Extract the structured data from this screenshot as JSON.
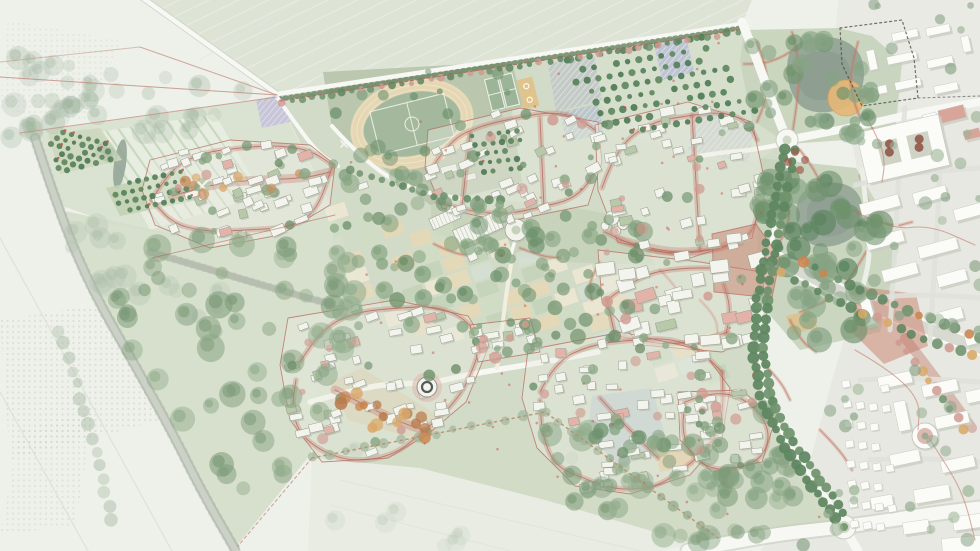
{
  "map": {
    "kind": "urban-masterplan-site-plan",
    "style": "watercolor aerial masterplan, no text labels visible in image",
    "palette": {
      "bg": "#eef0ea",
      "fieldSage": "#dde4d6",
      "fieldWest": "#dae2d2",
      "fieldBottom": "#e9ece3",
      "siteGreen": "#cfd9c3",
      "parkGreen": "#c8d4bd",
      "sportsGreen": "#b8c5ad",
      "stripeBase": "#e7ede0",
      "townGround": "#e7e8e1",
      "suburbGround": "#e9eae4",
      "roadWhite": "#f7f8f3",
      "roadCasing": "#c8cdc1",
      "roadGray": "#d8d9d1",
      "avenueInner": "#eef0ea",
      "streetRed": "#bf7062",
      "streetRedLine": "#b4685c",
      "plazaRed": "#c97f6e",
      "redPath": "#c4796a",
      "redDot": "#c4584a",
      "bldgFill": "#f3f4ed",
      "bldgStroke": "#989e90",
      "bldgShadow": "#b7beaf",
      "pinkRoof": "#e3b3a9",
      "greenRoof": "#b7c9a8",
      "townFill": "#fbfbf8",
      "townShadow": "#c9cdc2",
      "trackTan": "#e6d7b4",
      "pitchGreen": "#a3b89c",
      "courtGreen": "#9cb598",
      "courtTan": "#e0c48e",
      "courtLine": "#eef2e8",
      "orchardTree": "#55815a",
      "parkTree": "#6f926d",
      "parkTreeDark": "#5d8560",
      "softTree": "#8aa585",
      "faintTree": "#a9bca7",
      "pinkTree": "#cf9b91",
      "autumn1": "#d9a869",
      "autumn2": "#c9854f",
      "darkRedTree": "#8e4f41",
      "pond": "#93a496",
      "pondDark": "#87988c",
      "waterBlue": "#a7bdbd",
      "bluePark": "#9db4cb",
      "orangePlaza": "#e6b877",
      "lavender": "#c6c2d8",
      "solarBlue": "#bcc2d2",
      "solarGray": "#c2c9c6",
      "boundaryRed": "#b4675a",
      "fieldLineRed": "#c08b7c",
      "boundaryDot": "#4a4f49",
      "dottedPath": "#b98f6f",
      "hedgeGreen": "#5c7a55",
      "wallGray": "#c3c9bc"
    },
    "features": [
      "farm-fields",
      "field-boundary-lines",
      "tree-lined-avenue",
      "striped-crop-parcel",
      "west-orchards",
      "cigar-pond",
      "north-hedge-boundary",
      "country-road",
      "sports-park",
      "athletics-track",
      "football-pitch",
      "tennis-courts",
      "basketball-court",
      "orchard-grid",
      "solar-panel-fields",
      "lavender-plot",
      "pond-park",
      "park-pond",
      "orange-circle-plaza",
      "north-roundabout",
      "tree-promenade",
      "east-boulevard",
      "junction-plaza",
      "town-plaza",
      "east-park",
      "park-lake",
      "red-park-paths",
      "allotment-garden-patchwork",
      "central-campus",
      "greenhouse-building",
      "circular-courtyard-building",
      "round-tower-cluster",
      "neighborhood-northwest",
      "neighborhood-north",
      "neighborhood-northeast",
      "neighborhood-east",
      "neighborhood-southwest",
      "neighborhood-south",
      "southeast-village",
      "autumn-tree-street",
      "round-landmark-building",
      "blue-pocket-park",
      "existing-town",
      "school-courtyard-building",
      "pink-buildings",
      "ring-building",
      "small-house-rows",
      "existing-suburb",
      "dotted-site-boundary",
      "south-roundabout",
      "southern-arterial-road",
      "big-bottom-field",
      "green-buffer-woodland"
    ]
  }
}
